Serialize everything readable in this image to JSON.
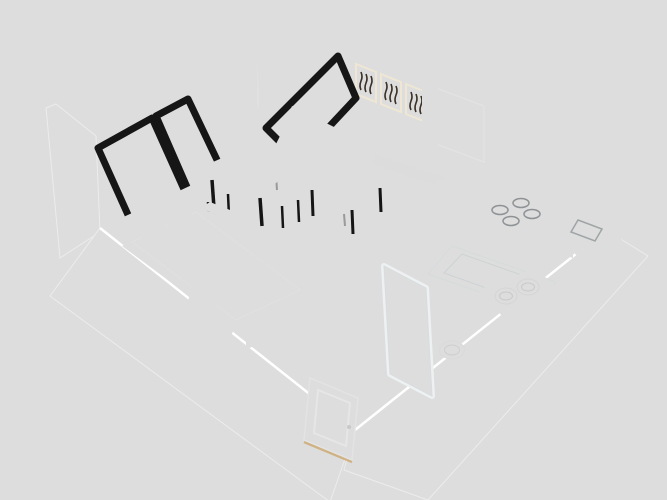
{
  "meta": {
    "type": "3d-apartment-floor-plan-render",
    "rooms": [
      "living-sleeping-area",
      "kitchen",
      "bathroom"
    ],
    "furniture": [
      "bed",
      "bench",
      "sofa",
      "coffee-table",
      "dining-table",
      "dining-chairs",
      "nightstand",
      "tall-cabinet",
      "kitchen-counter",
      "stove",
      "kitchen-sink",
      "bathtub",
      "vanity-basins",
      "toilet",
      "glass-partition",
      "entry-door",
      "windows",
      "curtains",
      "wall-art",
      "sloped-panels"
    ]
  },
  "colors": {
    "background": "#ffffff",
    "shadow": "#f0f0f0",
    "wall_top": "#63666a",
    "wall_nw": "#e9eaee",
    "wall_ne": "#f2f1ee",
    "wall_exterior": "#f7f7f8",
    "slab_sw": "#fbfbfb",
    "slab_se": "#f9f9fa",
    "skylight": "#f2f2f2",
    "panel_face": "#f5f5f6",
    "panel_frame": "#161616",
    "wood_base": "#c98a3e",
    "wood_dark": "#b7762e",
    "wood_mid": "#cf9347",
    "wood_light": "#daa45c",
    "wood_seam": "#8a5a22",
    "tile_black": "#17181a",
    "tile_white": "#edeff0",
    "curtain": "#2b3350",
    "window_glass": "#b3b8b9",
    "window_glass_tan": "#d6cfc0",
    "frame_white": "#f5f5f5",
    "sill": "#ededed",
    "art_tan": "#cdb88e",
    "art_ink": "#3a3026",
    "sofa": "#8e2b33",
    "sofa_dark": "#7c242d",
    "sofa_mid": "#95323b",
    "table_black": "#161616",
    "table_edge": "#0d0d0e",
    "top_sheen": "#2b2b2d",
    "chair_red": "#d23a2f",
    "chair_seat": "#c23329",
    "leg_black": "#151515",
    "bed_frame": "#18181a",
    "bed_foot": "#0f0f10",
    "mattress": "#f1f1f2",
    "bed_red": "#e8352b",
    "pillow_red": "#e23a2e",
    "pillow_dark": "#b92c24",
    "throw_red": "#cf2f27",
    "throw_dark": "#b8281f",
    "bench": "#9a9da0",
    "bench_front": "#717477",
    "cabinet_black": "#1a1a1c",
    "cabinet_side": "#0b0b0c",
    "cabinet_top": "#2e2e30",
    "counter_black": "#141414",
    "counter_base": "#e8e9ea",
    "burner_ring": "#8e9294",
    "burner_fill": "#1d1d1f",
    "sink_white": "#e9eced",
    "fixture_white": "#fafafa",
    "fixture_inner": "#f2f4f5",
    "vanity": "#1e1516",
    "vanity_front": "#120d0e",
    "glass_fill": "rgba(225,235,240,0.30)",
    "glass_frame": "#eef1f2",
    "door_white": "#fcfcfc",
    "threshold": "#caa05f"
  }
}
